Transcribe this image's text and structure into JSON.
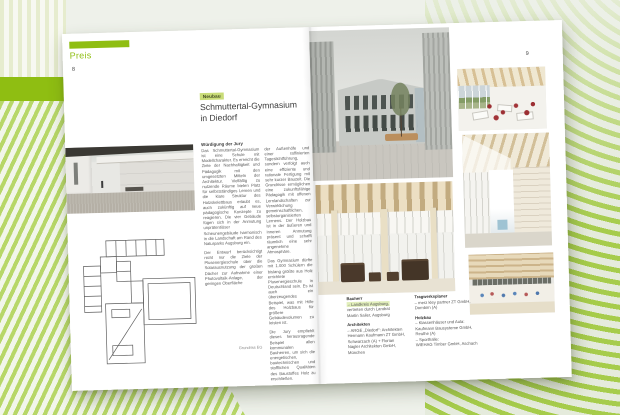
{
  "page_left": {
    "tab_label": "Preis",
    "page_number": "8",
    "category_label": "Neubau",
    "title_line1": "Schmuttertal-Gymnasium",
    "title_line2": "in Diedorf",
    "jury_heading": "Würdigung der Jury",
    "col1_paragraphs": [
      "Das Schmuttertal-Gymnasium ist eine Schule mit Modellcharakter. Es erreicht die Ziele der Nachhaltigkeit und Pädagogik mit den umgesetzten Mitteln der Architektur. Vielfältig zu nutzende Räume bieten Platz für selbstständiges Lernen und die klare Struktur des Holzskelettbaus erlaubt es, auch zukünftig auf neue pädagogische Konzepte zu reagieren. Die vier Gebäude fügen sich in der Anmutung unprätentiöser Scheunengebäude harmonisch in die Landschaft am Rand des Naturparks Augsburg ein.",
      "Der Entwurf berücksichtigt nicht nur die Ziele der Plusenergieschule über die Solarausnutzung der großen Dächer zur Aufnahme einer Photovoltaik-Anlage, der geringen Oberfläche"
    ],
    "col2_paragraphs": [
      "der Außenhöfe und einer raffinierten Tageslichtführung, sondern verfolgt auch eine effiziente und rationale Fertigung mit sehr kurzer Bauzeit. Die Grundrisse ermöglichen eine zukunftsfähige Pädagogik mit offenen Lernlandschaften zur Verwirklichung gemeinschaftlichen, selbstorganisierten Lernens. Der Holzbau ist in der äußeren und inneren Anmutung präsent und schafft räumlich eine sehr angenehme Atmosphäre.",
      "Das Gymnasium dürfte mit 1.000 Schülern die bislang größte aus Holz errichtete Plusenergieschule in Deutschland sein. Es ist auch ein überzeugendes Beispiel, was mit Hilfe des Holzbaus für größere Gebäudevolumen zu leisten ist.",
      "Die Jury empfiehlt dieses herausragende Beispiel allen kommunalen Bauherren, um sich die energetischen, bautechnischen und stofflichen Qualitäten des Baustoffes Holz zu erschließen."
    ],
    "plan_caption": "Grundriss EG"
  },
  "page_right": {
    "page_number": "9",
    "credits": {
      "bauherr": {
        "heading": "Bauherr",
        "lines": [
          "– Landkreis Augsburg,",
          "vertreten durch Landrat",
          "Martin Sailer, Augsburg"
        ]
      },
      "architekten": {
        "heading": "Architekten",
        "lines": [
          "– ARGE „Diedorf“: Architekten",
          "Hermann Kaufmann ZT GmbH,",
          "Schwarzach (A) + Florian",
          "Nagler Architekten GmbH,",
          "München"
        ]
      },
      "tragwerksplaner": {
        "heading": "Tragwerksplaner",
        "lines": [
          "– merz kley partner ZT GmbH,",
          "Dornbirn (A)"
        ]
      },
      "holzbau": {
        "heading": "Holzbau",
        "lines": [
          "– Klassenhäuser und Aula:",
          "Kaufmann Bausysteme GmbH,",
          "Reuthe (A)",
          "– Sporthalle:",
          "WIEHAG Timber GmbH, Aschach"
        ]
      }
    }
  },
  "colors": {
    "accent_green": "#8fbe12",
    "category_label_bg": "#c9dc78",
    "highlight_bg": "#e2efbb",
    "pale_stripe": "#e6ecce",
    "diagonal_stripe": "#b7d768",
    "wave_green": "#a6cc4b"
  }
}
